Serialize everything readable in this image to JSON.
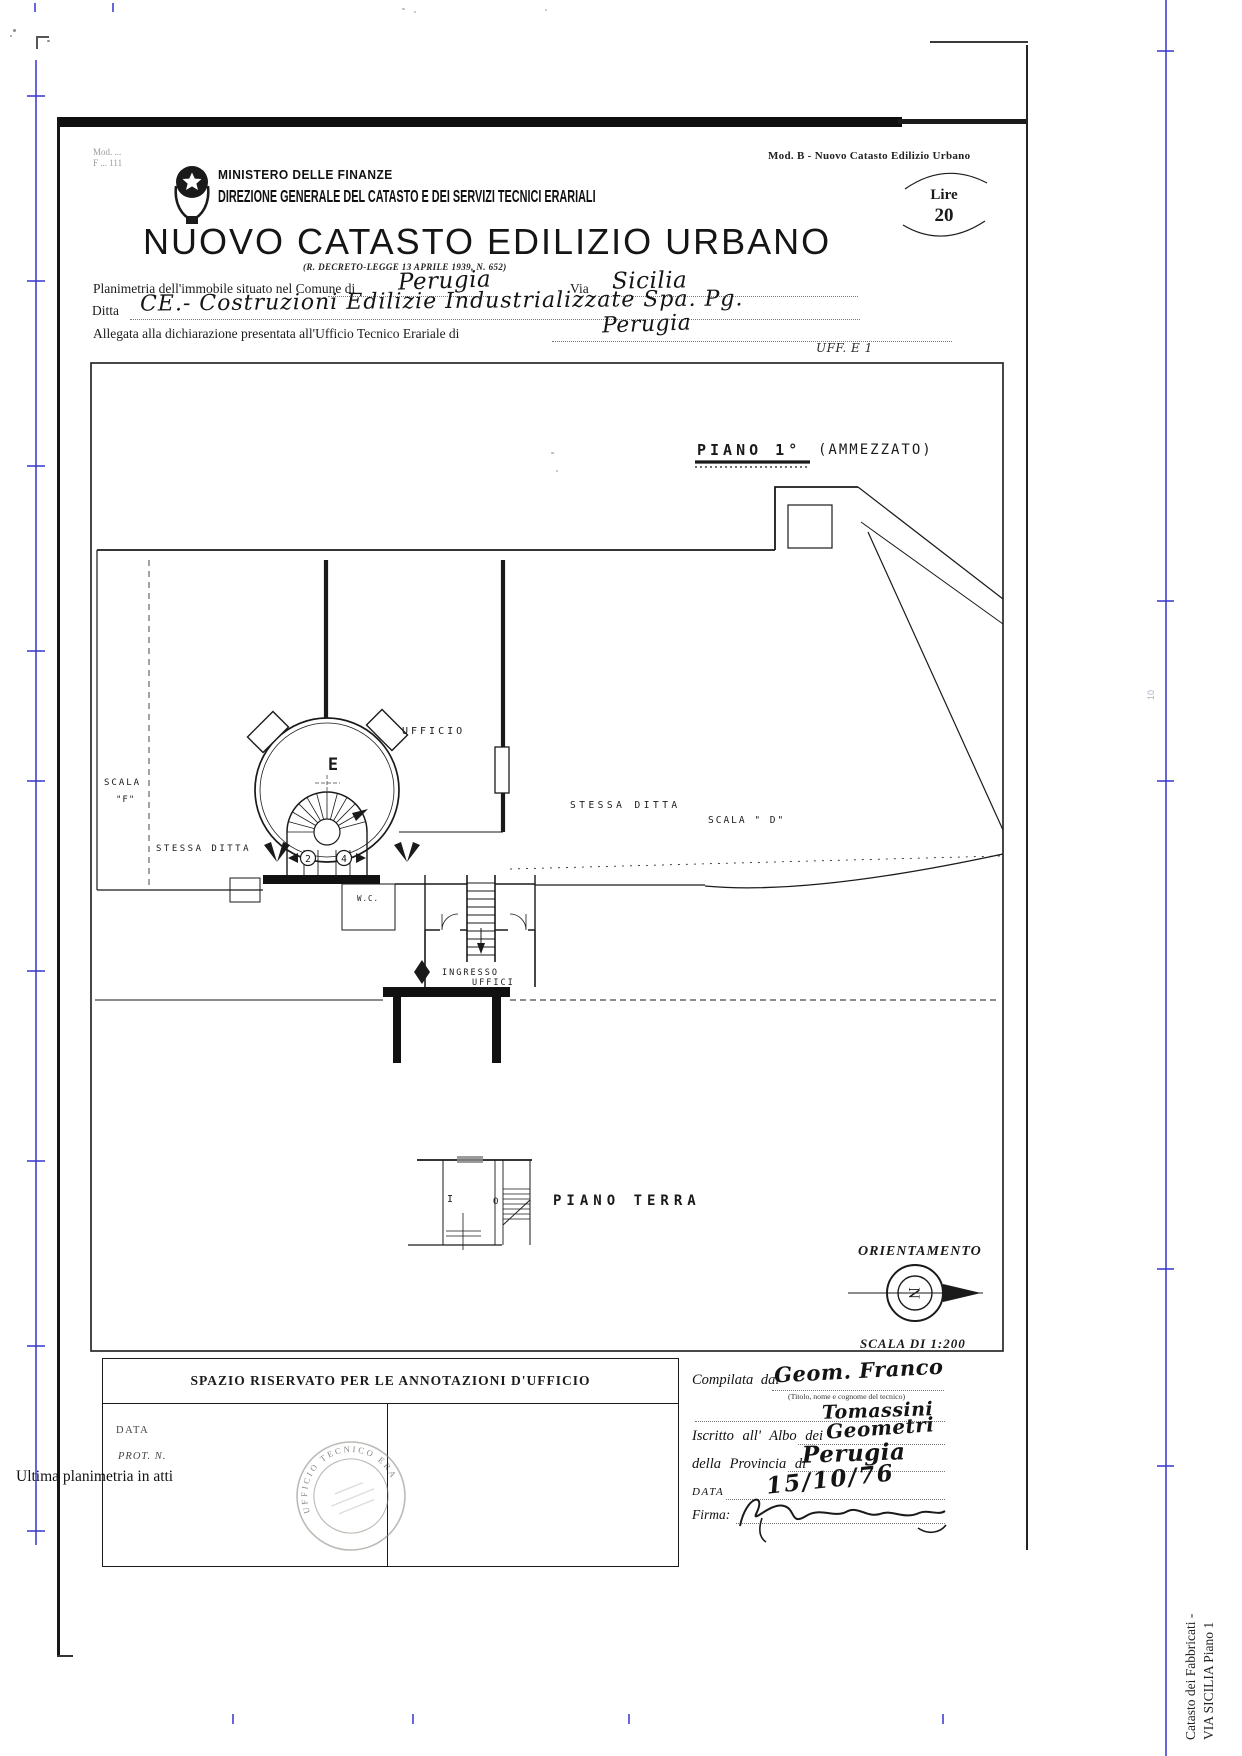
{
  "header": {
    "mod_left_line1": "Mod. ...",
    "mod_left_line2": "F ... 111",
    "mod_right": "Mod. B - Nuovo Catasto Edilizio Urbano",
    "ministry": "MINISTERO DELLE FINANZE",
    "direction": "DIREZIONE GENERALE DEL CATASTO E DEI SERVIZI TECNICI ERARIALI",
    "title": "NUOVO CATASTO EDILIZIO URBANO",
    "law_ref": "(R. DECRETO-LEGGE 13 APRILE 1939, N. 652)",
    "lire_label": "Lire",
    "lire_value": "20"
  },
  "form": {
    "line1_label": "Planimetria dell'immobile situato nel Comune di",
    "line1_value": "Perugia",
    "via_label": "Via",
    "via_value": "Sicilia",
    "ditta_label": "Ditta",
    "ditta_value": "CE.- Costruzioni Edilizie Industrializzate Spa. Pg.",
    "allegata_label": "Allegata alla dichiarazione presentata all'Ufficio Tecnico Erariale di",
    "allegata_value": "Perugia",
    "uff_note": "UFF. E 1"
  },
  "plan": {
    "floor_title": "PIANO 1°",
    "floor_title_suffix": "(AMMEZZATO)",
    "labels": {
      "ufficio": "UFFICIO",
      "room_e": "E",
      "scala_f_line1": "SCALA",
      "scala_f_line2": "\"F\"",
      "stessa_ditta_left": "STESSA DITTA",
      "stessa_ditta_center": "STESSA DITTA",
      "scala_d": "SCALA \" D\"",
      "wc": "W.C.",
      "ingresso_line1": "INGRESSO",
      "ingresso_line2": "UFFICI",
      "num2": "2",
      "num4": "4",
      "pt_i": "I",
      "pt_o": "O",
      "piano_terra": "PIANO TERRA"
    },
    "orientation_title": "ORIENTAMENTO",
    "compass_letter": "N",
    "scale_note": "SCALA DI 1:200"
  },
  "annotations": {
    "title": "SPAZIO RISERVATO PER LE ANNOTAZIONI D'UFFICIO",
    "data_label": "DATA",
    "prot_label": "PROT. N.",
    "stamp_arc_text": "UFFICIO TECNICO ERARIALE"
  },
  "compiler": {
    "compilata_label": "Compilata dal",
    "compilata_value": "Geom. Franco",
    "titolo_note": "(Titolo, nome e cognome del tecnico)",
    "surname_value": "Tomassini",
    "iscritto_label": "Iscritto all' Albo dei",
    "iscritto_value": "Geometri",
    "provincia_label": "della Provincia di",
    "provincia_value": "Perugia",
    "data_label": "DATA",
    "data_value": "15/10/76",
    "firma_label": "Firma:"
  },
  "page": {
    "bottom_note": "Ultima planimetria in atti",
    "margin_vertical_line1": "Catasto dei Fabbricati -",
    "margin_vertical_line2": "VIA SICILIA Piano 1",
    "margin_ruler_note": "10"
  }
}
